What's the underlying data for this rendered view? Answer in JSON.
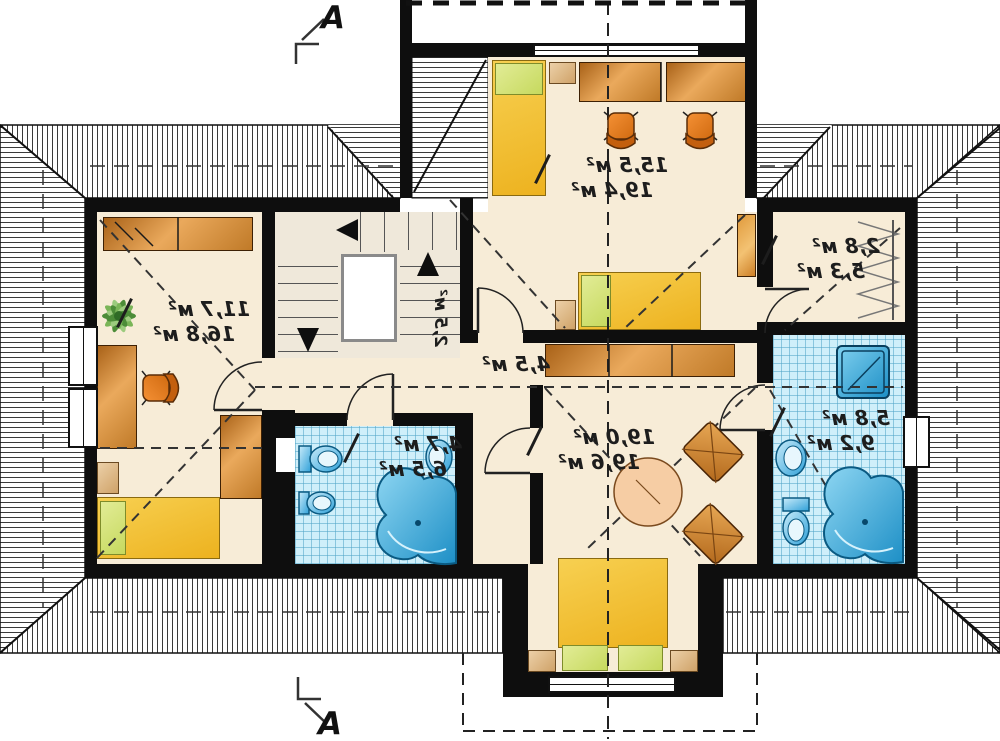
{
  "plan_type": "attic floor plan",
  "section": {
    "letter": "A"
  },
  "rooms": {
    "left_bedroom": {
      "area_floor": "11,7 м²",
      "area_total": "16,8 м²"
    },
    "top_bedroom": {
      "area_floor": "15,5 м²",
      "area_total": "19,4 м²"
    },
    "closet": {
      "area_floor": "2,8 м²",
      "area_total": "5,3 м²"
    },
    "bathroom_right": {
      "area_floor": "5,8 м²",
      "area_total": "9,2 м²"
    },
    "center_bedroom": {
      "area_floor": "19,0 м²",
      "area_total": "19,6 м²"
    },
    "bathroom_middle": {
      "area_floor": "4,7 м²",
      "area_total": "6,5 м²"
    },
    "hall": {
      "area_floor": "4,5 м²"
    },
    "staircase": {
      "area_floor": "2,5 м²"
    }
  },
  "colors": {
    "wall": "#0e0e0e",
    "floor": "#f7ecd7",
    "tile_floor": "#cfeffa",
    "wood": "#c98434",
    "bed_yellow": "#f2c43d",
    "pillow_green": "#cdd96a",
    "fixture_blue": "#2fa0d8",
    "chair_orange": "#e07a1a"
  }
}
